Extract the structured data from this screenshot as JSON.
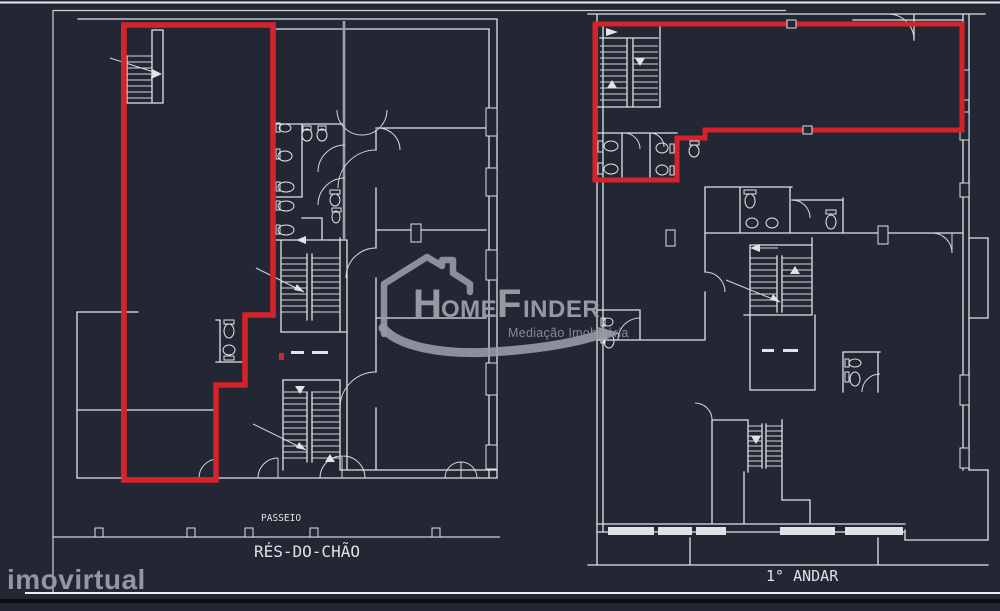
{
  "image": {
    "description": "Dark CAD architectural drawing with two floor plans; red outlines highlight the listed unit on each storey",
    "background": "#222733"
  },
  "colors": {
    "background": "#222733",
    "line": "#dfe3e7",
    "line_dim": "#9aa1a8",
    "highlight_red": "#d6232b",
    "watermark_gray": "#9aa1ab",
    "bottom_band": "#0a0c10"
  },
  "plans": {
    "ground_floor": {
      "label": "RÉS-DO-CHÃO",
      "sidewalk_label": "PASSEIO"
    },
    "first_floor": {
      "label": "1° ANDAR"
    }
  },
  "watermark": {
    "brand": {
      "part1": "H",
      "part2": "OME",
      "part3": "F",
      "part4": "INDER"
    },
    "subtitle": "Mediação Imobiliária"
  },
  "portal": {
    "name": "imovirtual"
  }
}
